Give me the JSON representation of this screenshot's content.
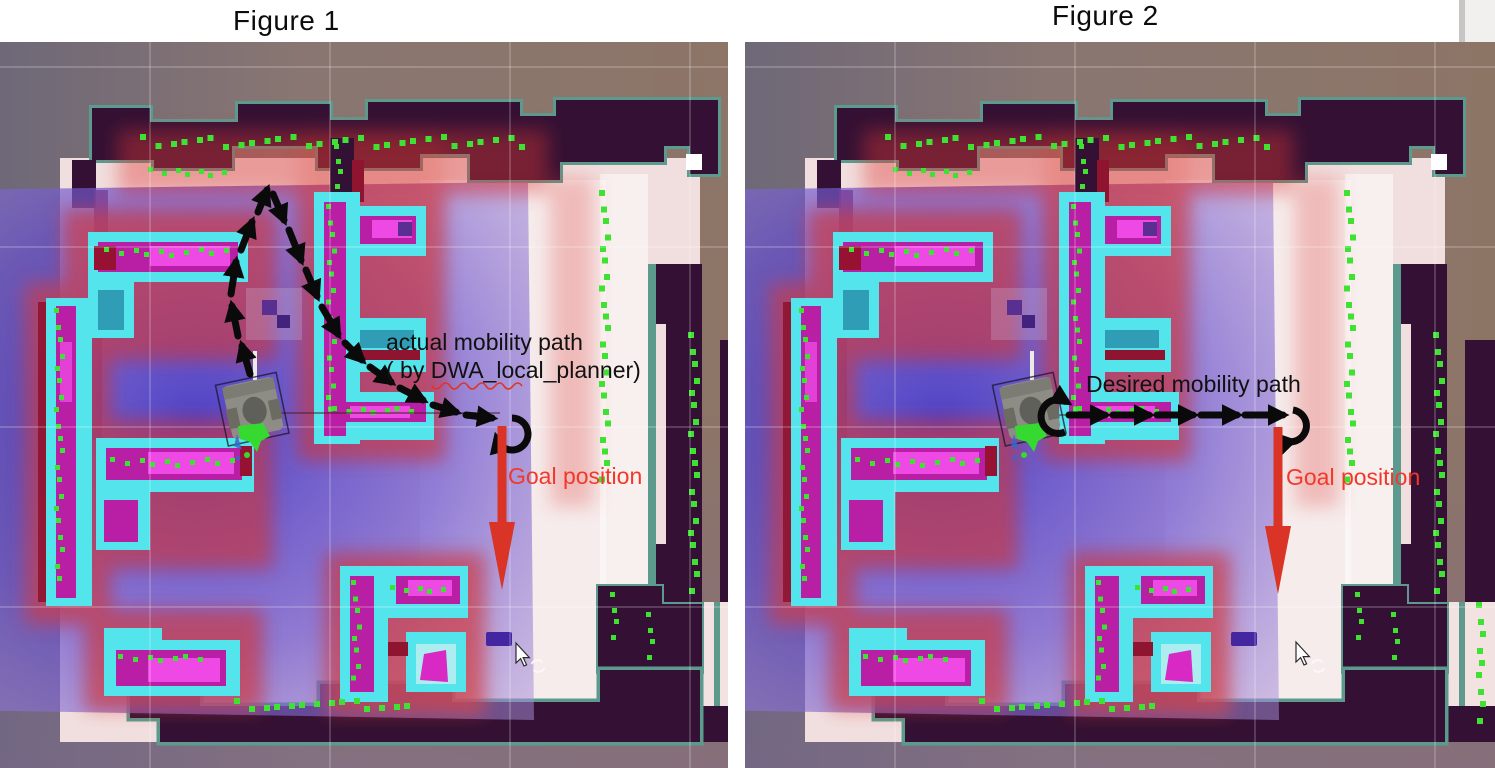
{
  "figures": [
    {
      "id": "figure1",
      "title": "Figure 1",
      "annotation_line1": "actual mobility path",
      "annotation_line2": "( by DWA_local_planner)",
      "goal_label": "Goal position",
      "path_style": "curved arc from robot up and around to goal"
    },
    {
      "id": "figure2",
      "title": "Figure 2",
      "annotation_line1": "Desired mobility path",
      "annotation_line2": "",
      "goal_label": "Goal position",
      "path_style": "straight horizontal line from robot to goal"
    }
  ],
  "colors": {
    "wall_dark": "#341134",
    "wall_border_teal": "#5d9a8e",
    "obstacle_cyan": "#54e4ec",
    "obstacle_magenta": "#b81fa4",
    "obstacle_pink": "#ee49e4",
    "laser_green": "#3fe233",
    "inflation_red": "#dd3a33",
    "costmap_blue": "#4a3fc4",
    "free_space_pale": "#f1dfdf",
    "outside_brown": "#8b7569",
    "goal_arrow_red": "#d93425",
    "goal_label_red": "#f0392a",
    "annotation_black": "#111111",
    "path_black": "#0a0a0a"
  },
  "icons": {
    "mouse_cursor": "pointer-arrow",
    "rotate_tool": "circular-arrows"
  }
}
